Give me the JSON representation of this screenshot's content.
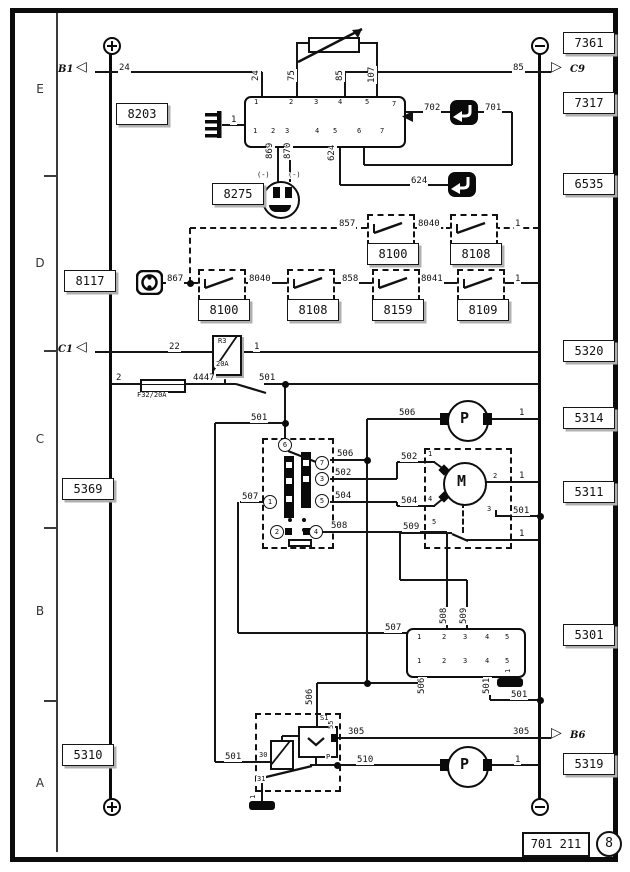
{
  "diagram": {
    "sheet_code": "701 211",
    "sheet_circle": "8",
    "margin_rows": [
      "E",
      "D",
      "C",
      "B",
      "A"
    ],
    "refs": {
      "b8203": "8203",
      "b7361": "7361",
      "b7317": "7317",
      "b6535": "6535",
      "b8275": "8275",
      "b8117": "8117",
      "b5320": "5320",
      "b5314": "5314",
      "b5369": "5369",
      "b5311": "5311",
      "b5301": "5301",
      "b5310": "5310",
      "b5319": "5319",
      "sw": [
        "8100",
        "8108",
        "8100",
        "8108",
        "8159",
        "8109"
      ]
    },
    "relay_r3": {
      "name": "R3",
      "rating": "20A"
    },
    "fuse": {
      "label": "F32/20A"
    },
    "arrows": [
      {
        "glyph": "◁",
        "label": "B1",
        "gx": 76,
        "gy": 63,
        "lx": 58,
        "ly": 65
      },
      {
        "glyph": "▷",
        "label": "C9",
        "gx": 551,
        "gy": 63,
        "lx": 570,
        "ly": 65
      },
      {
        "glyph": "◁",
        "label": "C1",
        "gx": 76,
        "gy": 343,
        "lx": 58,
        "ly": 345
      },
      {
        "glyph": "▷",
        "label": "B6",
        "gx": 551,
        "gy": 729,
        "lx": 570,
        "ly": 731
      }
    ],
    "circled_pins": [
      {
        "t": "6",
        "x": 285,
        "y": 445
      },
      {
        "t": "7",
        "x": 322,
        "y": 463
      },
      {
        "t": "3",
        "x": 322,
        "y": 479
      },
      {
        "t": "5",
        "x": 322,
        "y": 501
      },
      {
        "t": "1",
        "x": 270,
        "y": 502
      },
      {
        "t": "2",
        "x": 277,
        "y": 532
      },
      {
        "t": "4",
        "x": 316,
        "y": 532
      }
    ],
    "labels": [
      {
        "t": "24",
        "x": 118,
        "y": 64
      },
      {
        "t": "24",
        "x": 252,
        "y": 82,
        "c": "r"
      },
      {
        "t": "75",
        "x": 288,
        "y": 82,
        "c": "r"
      },
      {
        "t": "85",
        "x": 336,
        "y": 82,
        "c": "r"
      },
      {
        "t": "107",
        "x": 368,
        "y": 84,
        "c": "r"
      },
      {
        "t": "85",
        "x": 512,
        "y": 64
      },
      {
        "t": "702",
        "x": 423,
        "y": 104
      },
      {
        "t": "701",
        "x": 484,
        "y": 104
      },
      {
        "t": "1",
        "x": 230,
        "y": 116
      },
      {
        "t": "869",
        "x": 266,
        "y": 160,
        "c": "r"
      },
      {
        "t": "870",
        "x": 284,
        "y": 160,
        "c": "r"
      },
      {
        "t": "(-)",
        "x": 256,
        "y": 172,
        "c": "s"
      },
      {
        "t": "(-)",
        "x": 287,
        "y": 172,
        "c": "s"
      },
      {
        "t": "624",
        "x": 328,
        "y": 162,
        "c": "r"
      },
      {
        "t": "624",
        "x": 410,
        "y": 177
      },
      {
        "t": "857",
        "x": 338,
        "y": 220
      },
      {
        "t": "8040",
        "x": 417,
        "y": 220
      },
      {
        "t": "1",
        "x": 514,
        "y": 220
      },
      {
        "t": "867",
        "x": 166,
        "y": 275
      },
      {
        "t": "8040",
        "x": 248,
        "y": 275
      },
      {
        "t": "858",
        "x": 341,
        "y": 275
      },
      {
        "t": "8041",
        "x": 420,
        "y": 275
      },
      {
        "t": "1",
        "x": 514,
        "y": 275
      },
      {
        "t": "22",
        "x": 168,
        "y": 343
      },
      {
        "t": "1",
        "x": 253,
        "y": 343
      },
      {
        "t": "2",
        "x": 115,
        "y": 374
      },
      {
        "t": "4447",
        "x": 192,
        "y": 374
      },
      {
        "t": "F32/20A",
        "x": 136,
        "y": 392,
        "c": "s"
      },
      {
        "t": "501",
        "x": 258,
        "y": 374
      },
      {
        "t": "501",
        "x": 250,
        "y": 414
      },
      {
        "t": "506",
        "x": 336,
        "y": 450
      },
      {
        "t": "502",
        "x": 334,
        "y": 469
      },
      {
        "t": "502",
        "x": 400,
        "y": 453
      },
      {
        "t": "504",
        "x": 334,
        "y": 492
      },
      {
        "t": "504",
        "x": 400,
        "y": 497
      },
      {
        "t": "507",
        "x": 241,
        "y": 493
      },
      {
        "t": "508",
        "x": 330,
        "y": 522
      },
      {
        "t": "509",
        "x": 402,
        "y": 523
      },
      {
        "t": "506",
        "x": 398,
        "y": 409
      },
      {
        "t": "1",
        "x": 518,
        "y": 409
      },
      {
        "t": "1",
        "x": 518,
        "y": 472
      },
      {
        "t": "501",
        "x": 512,
        "y": 507
      },
      {
        "t": "1",
        "x": 518,
        "y": 530
      },
      {
        "t": "508",
        "x": 440,
        "y": 625,
        "c": "r"
      },
      {
        "t": "509",
        "x": 460,
        "y": 625,
        "c": "r"
      },
      {
        "t": "507",
        "x": 384,
        "y": 624
      },
      {
        "t": "506",
        "x": 418,
        "y": 695,
        "c": "r"
      },
      {
        "t": "501",
        "x": 483,
        "y": 695,
        "c": "r"
      },
      {
        "t": "1",
        "x": 505,
        "y": 674,
        "c": "sr"
      },
      {
        "t": "501",
        "x": 510,
        "y": 691
      },
      {
        "t": "506",
        "x": 306,
        "y": 706,
        "c": "r"
      },
      {
        "t": "501",
        "x": 224,
        "y": 753
      },
      {
        "t": "305",
        "x": 347,
        "y": 728
      },
      {
        "t": "305",
        "x": 512,
        "y": 728
      },
      {
        "t": "510",
        "x": 356,
        "y": 756
      },
      {
        "t": "1",
        "x": 514,
        "y": 756
      },
      {
        "t": "1",
        "x": 250,
        "y": 800,
        "c": "sr"
      },
      {
        "t": "S1",
        "x": 319,
        "y": 715,
        "c": "s"
      },
      {
        "t": "55",
        "x": 328,
        "y": 730,
        "c": "sr"
      },
      {
        "t": "P",
        "x": 325,
        "y": 754,
        "c": "s"
      },
      {
        "t": "30",
        "x": 258,
        "y": 752,
        "c": "s"
      },
      {
        "t": "31",
        "x": 256,
        "y": 776,
        "c": "s"
      },
      {
        "t": "1",
        "x": 427,
        "y": 451,
        "c": "s"
      },
      {
        "t": "4",
        "x": 427,
        "y": 496,
        "c": "s"
      },
      {
        "t": "2",
        "x": 492,
        "y": 473,
        "c": "s"
      },
      {
        "t": "3",
        "x": 486,
        "y": 506,
        "c": "s"
      },
      {
        "t": "5",
        "x": 431,
        "y": 519,
        "c": "s"
      },
      {
        "t": "1",
        "x": 253,
        "y": 99,
        "c": "s"
      },
      {
        "t": "2",
        "x": 288,
        "y": 99,
        "c": "s"
      },
      {
        "t": "3",
        "x": 313,
        "y": 99,
        "c": "s"
      },
      {
        "t": "4",
        "x": 337,
        "y": 99,
        "c": "s"
      },
      {
        "t": "5",
        "x": 364,
        "y": 99,
        "c": "s"
      },
      {
        "t": "7",
        "x": 391,
        "y": 101,
        "c": "s"
      },
      {
        "t": "1",
        "x": 252,
        "y": 128,
        "c": "s"
      },
      {
        "t": "2",
        "x": 270,
        "y": 128,
        "c": "s"
      },
      {
        "t": "3",
        "x": 284,
        "y": 128,
        "c": "s"
      },
      {
        "t": "4",
        "x": 314,
        "y": 128,
        "c": "s"
      },
      {
        "t": "5",
        "x": 332,
        "y": 128,
        "c": "s"
      },
      {
        "t": "6",
        "x": 356,
        "y": 128,
        "c": "s"
      },
      {
        "t": "7",
        "x": 379,
        "y": 128,
        "c": "s"
      },
      {
        "t": "1",
        "x": 416,
        "y": 634,
        "c": "s"
      },
      {
        "t": "2",
        "x": 441,
        "y": 634,
        "c": "s"
      },
      {
        "t": "3",
        "x": 462,
        "y": 634,
        "c": "s"
      },
      {
        "t": "4",
        "x": 484,
        "y": 634,
        "c": "s"
      },
      {
        "t": "5",
        "x": 504,
        "y": 634,
        "c": "s"
      },
      {
        "t": "1",
        "x": 416,
        "y": 658,
        "c": "s"
      },
      {
        "t": "2",
        "x": 441,
        "y": 658,
        "c": "s"
      },
      {
        "t": "3",
        "x": 462,
        "y": 658,
        "c": "s"
      },
      {
        "t": "4",
        "x": 484,
        "y": 658,
        "c": "s"
      },
      {
        "t": "5",
        "x": 504,
        "y": 658,
        "c": "s"
      },
      {
        "t": "M",
        "x": 456,
        "y": 474,
        "c": "big"
      },
      {
        "t": "P",
        "x": 459,
        "y": 411,
        "c": "big"
      },
      {
        "t": "P",
        "x": 459,
        "y": 757,
        "c": "big"
      }
    ]
  }
}
